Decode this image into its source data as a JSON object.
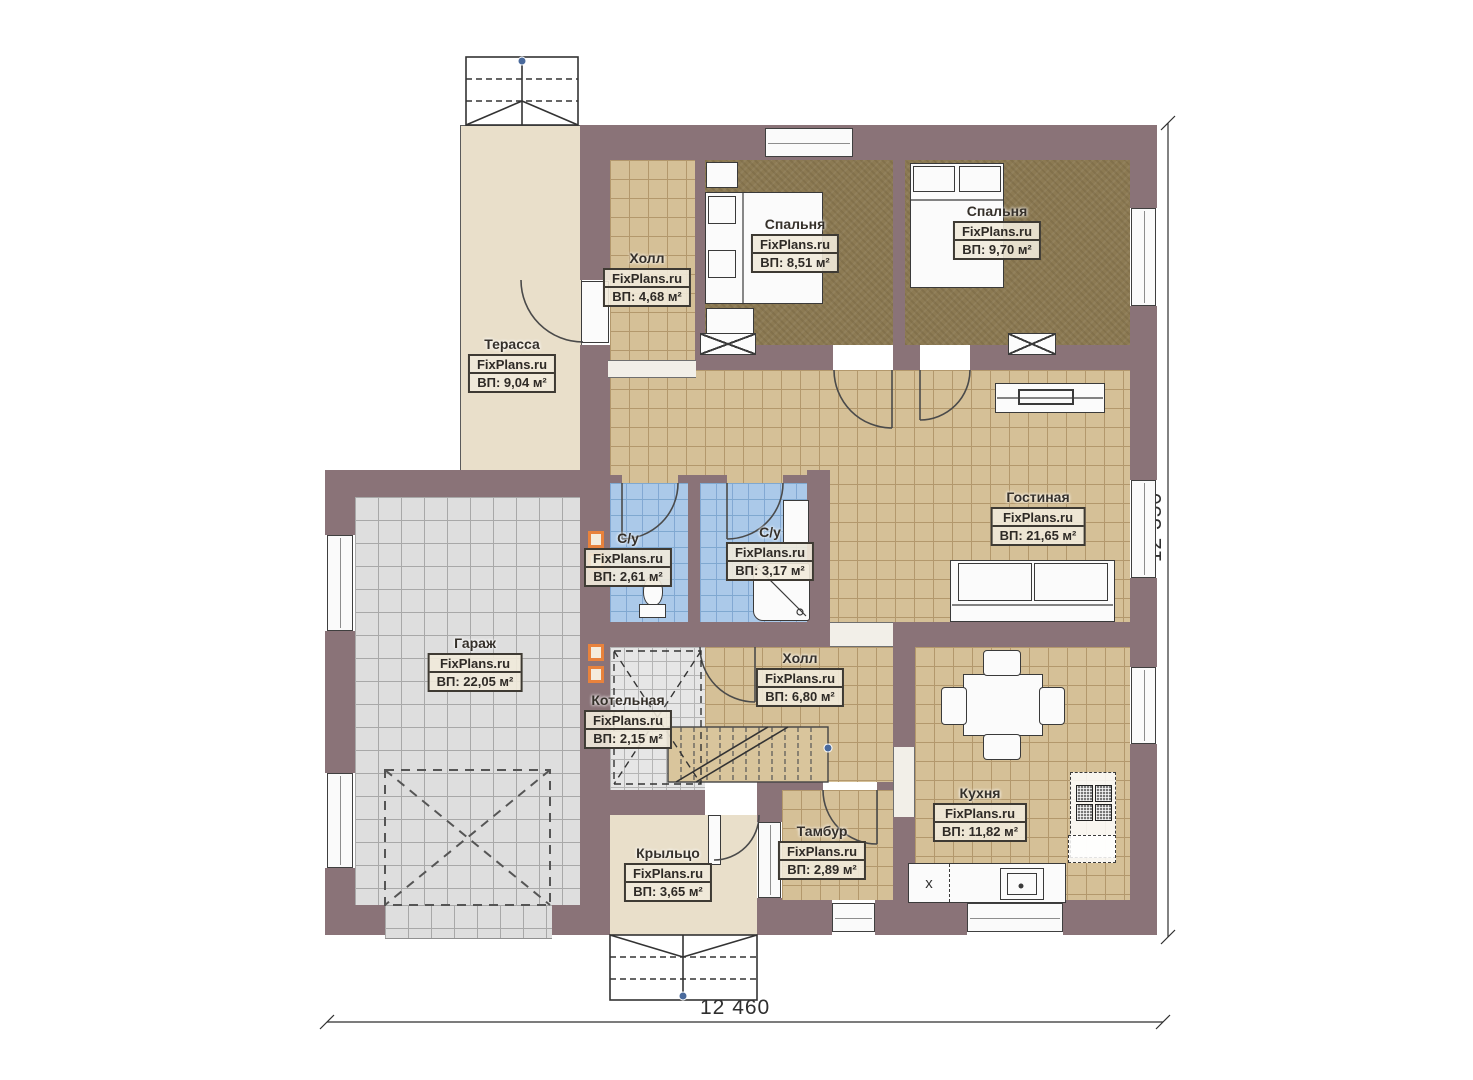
{
  "watermark": "FixPlans.ru",
  "rooms": {
    "terrace": {
      "name": "Терасса",
      "area": "ВП: 9,04 м²"
    },
    "hall_top": {
      "name": "Холл",
      "area": "ВП: 4,68 м²"
    },
    "bedroom1": {
      "name": "Спальня",
      "area": "ВП: 8,51 м²"
    },
    "bedroom2": {
      "name": "Спальня",
      "area": "ВП: 9,70 м²"
    },
    "living": {
      "name": "Гостиная",
      "area": "ВП: 21,65 м²"
    },
    "wc1": {
      "name": "С/у",
      "area": "ВП: 2,61 м²"
    },
    "wc2": {
      "name": "С/у",
      "area": "ВП: 3,17 м²"
    },
    "garage": {
      "name": "Гараж",
      "area": "ВП: 22,05 м²"
    },
    "boiler": {
      "name": "Котельная",
      "area": "ВП: 2,15 м²"
    },
    "hall_bottom": {
      "name": "Холл",
      "area": "ВП: 6,80 м²"
    },
    "kitchen": {
      "name": "Кухня",
      "area": "ВП: 11,82 м²"
    },
    "tambour": {
      "name": "Тамбур",
      "area": "ВП: 2,89 м²"
    },
    "porch": {
      "name": "Крыльцо",
      "area": "ВП: 3,65 м²"
    }
  },
  "dimensions": {
    "bottom": "12 460",
    "right": "12 350"
  },
  "kitchen_marks": {
    "cabinet_x": "x"
  },
  "colors": {
    "wall": "#8a7378",
    "tile_beige": "#d5c097",
    "tile_blue": "#abc9e9",
    "tile_gray": "#dedede",
    "carpet": "#8c7a53",
    "vent_accent": "#e8823c"
  }
}
